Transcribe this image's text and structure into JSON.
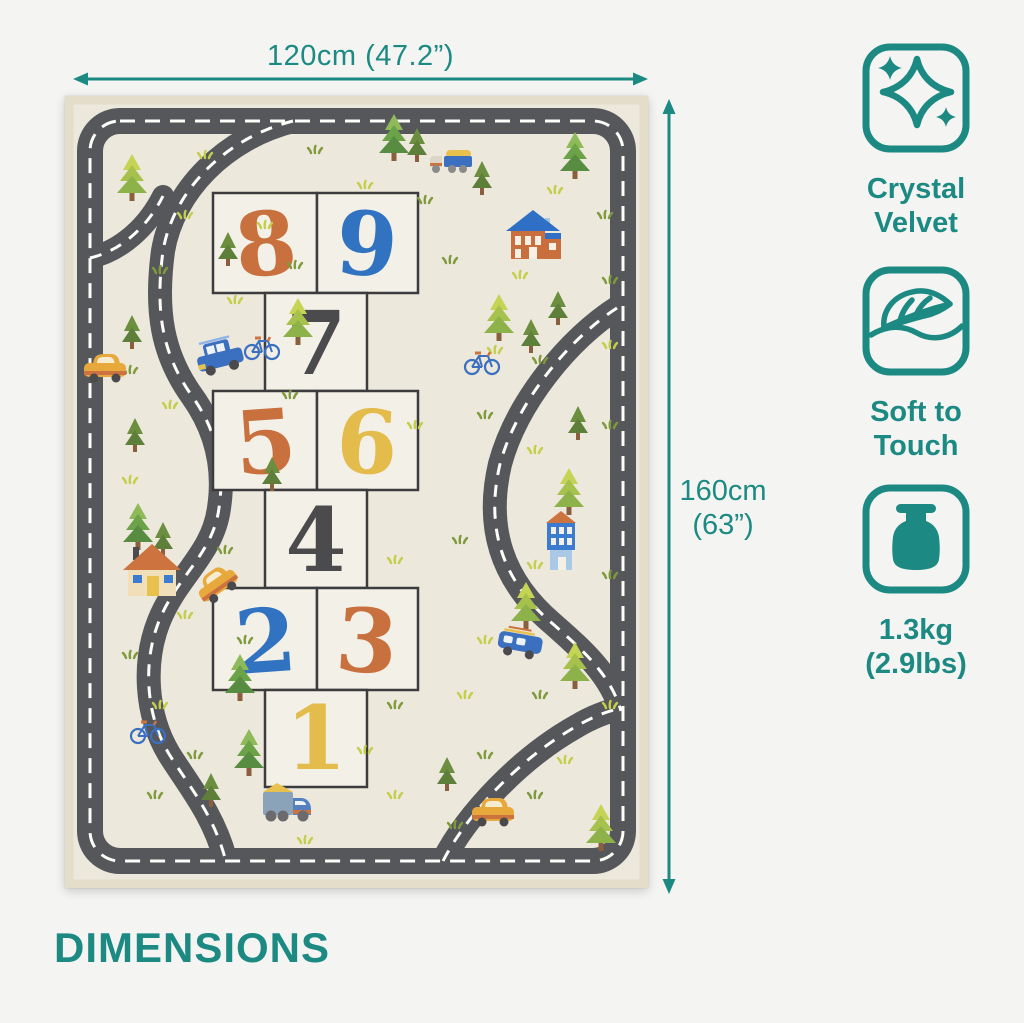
{
  "page": {
    "section_title": "DIMENSIONS"
  },
  "dimension_annotations": {
    "width": "120cm (47.2”)",
    "height_line1": "160cm",
    "height_line2": "(63”)"
  },
  "features": [
    {
      "icon": "sparkle-icon",
      "line1": "Crystal",
      "line2": "Velvet"
    },
    {
      "icon": "feather-icon",
      "line1": "Soft to",
      "line2": "Touch"
    },
    {
      "icon": "weight-icon",
      "line1": "1.3kg",
      "line2": "(2.9lbs)"
    }
  ],
  "mat": {
    "hopscotch_numbers": [
      "8",
      "9",
      "7",
      "5",
      "6",
      "4",
      "2",
      "3",
      "1"
    ]
  },
  "palette": {
    "teal": "#1C8A82",
    "road_gray": "#56575B",
    "mat_cream": "#ECE8DC",
    "box_cream": "#F3F0E7",
    "number_orange": "#C9703F",
    "number_blue": "#3173C0",
    "number_charcoal": "#4B4B4D",
    "number_yellow": "#E3BC4C"
  }
}
